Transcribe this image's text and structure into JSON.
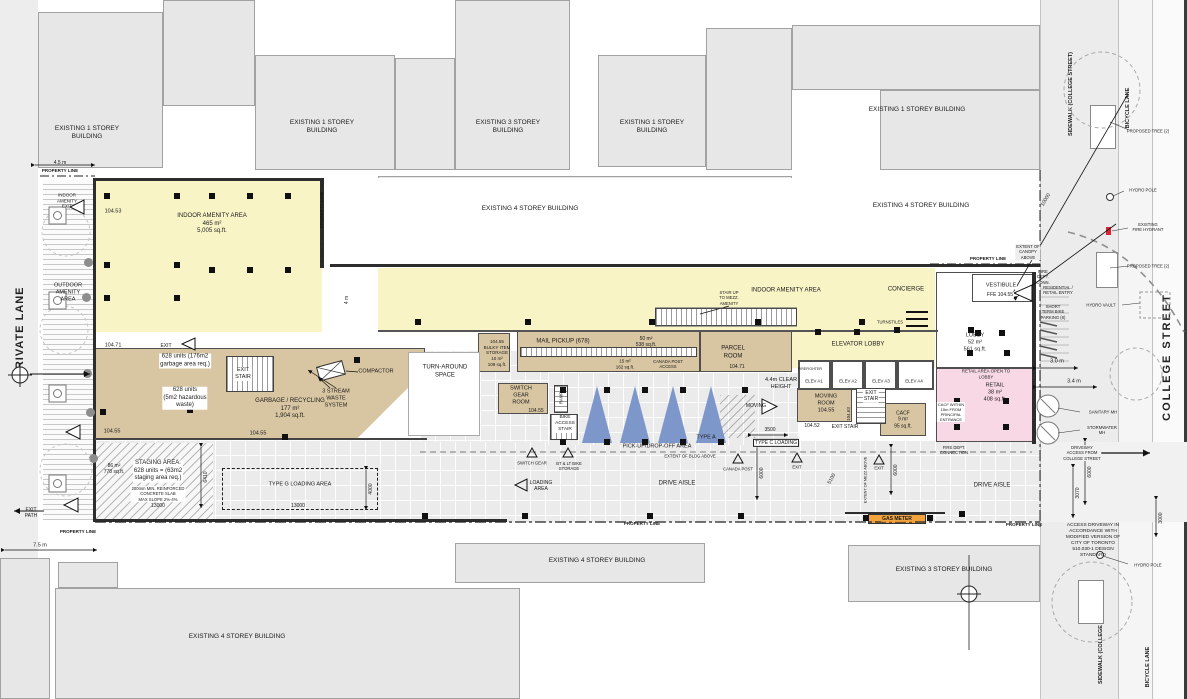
{
  "streets": {
    "private_lane": "PRIVATE LANE",
    "college_street": "COLLEGE STREET",
    "sidewalk_college_top": "SIDEWALK (COLLEGE STREET)",
    "bicycle_lane_top": "BICYCLE LANE",
    "sidewalk_college_bottom": "SIDEWALK (COLLEGE STREET)",
    "bicycle_lane_bottom": "BICYCLE LANE"
  },
  "colors": {
    "amenity_yellow": "#f8f4c6",
    "service_tan": "#d8c5a2",
    "retail_pink": "#f8d8e4",
    "tree_blue": "#7e97cb",
    "gas_meter_orange": "#f2a33c",
    "existing_building_gray": "#e7e7e7"
  },
  "annotations": [
    {
      "n": "bldg-label",
      "t": "EXISTING 1 STOREY\nBUILDING",
      "x": 87,
      "y": 133,
      "s": 6.5
    },
    {
      "n": "bldg-label",
      "t": "EXISTING 1 STOREY\nBUILDING",
      "x": 322,
      "y": 127,
      "s": 6.5
    },
    {
      "n": "bldg-label",
      "t": "EXISTING 3 STOREY\nBUILDING",
      "x": 508,
      "y": 127,
      "s": 6.5
    },
    {
      "n": "bldg-label",
      "t": "EXISTING 1 STOREY\nBUILDING",
      "x": 652,
      "y": 127,
      "s": 6.5
    },
    {
      "n": "bldg-label",
      "t": "EXISTING 1 STOREY BUILDING",
      "x": 917,
      "y": 110,
      "s": 6.5
    },
    {
      "n": "bldg-label",
      "t": "EXISTING 4 STOREY BUILDING",
      "x": 530,
      "y": 209,
      "s": 6.5
    },
    {
      "n": "bldg-label",
      "t": "EXISTING 4 STOREY BUILDING",
      "x": 921,
      "y": 206,
      "s": 6.5
    },
    {
      "n": "bldg-label",
      "t": "EXISTING 4 STOREY BUILDING",
      "x": 597,
      "y": 561,
      "s": 6.5
    },
    {
      "n": "bldg-label",
      "t": "EXISTING 3 STOREY BUILDING",
      "x": 944,
      "y": 570,
      "s": 6.5
    },
    {
      "n": "bldg-label",
      "t": "EXISTING 4 STOREY BUILDING",
      "x": 237,
      "y": 637,
      "s": 6.5
    },
    {
      "n": "room-label-indoor-amenity-west",
      "t": "INDOOR AMENITY AREA\n465 m²\n5,005 sq.ft.",
      "x": 212,
      "y": 224
    },
    {
      "n": "elevation-label",
      "t": "104.53",
      "x": 113,
      "y": 212,
      "s": 5.5
    },
    {
      "n": "room-label-outdoor-amenity",
      "t": "OUTDOOR\nAMENITY\nAREA",
      "x": 68,
      "y": 293,
      "s": 5.5
    },
    {
      "n": "room-label-indoor-amenity-exit",
      "t": "INDOOR\nAMENITY\nEXIT",
      "x": 67,
      "y": 201,
      "s": 4.5
    },
    {
      "n": "property-line-label",
      "t": "PROPERTY LINE",
      "x": 60,
      "y": 171,
      "s": 4.5,
      "b": 1
    },
    {
      "n": "dim-label",
      "t": "4.5 m",
      "x": 60,
      "y": 163,
      "s": 5
    },
    {
      "n": "property-line-label",
      "t": "PROPERTY LINE",
      "x": 322,
      "y": 210,
      "r": -90,
      "s": 4.5,
      "b": 1
    },
    {
      "n": "dim-label",
      "t": "4 m",
      "x": 347,
      "y": 300,
      "r": -90,
      "s": 5
    },
    {
      "n": "elevation-label",
      "t": "104.71",
      "x": 113,
      "y": 346,
      "s": 5.5
    },
    {
      "n": "exit-label",
      "t": "EXIT",
      "x": 166,
      "y": 346,
      "s": 5
    },
    {
      "n": "room-label-exit-stair",
      "t": "EXIT\nSTAIR",
      "x": 243,
      "y": 374,
      "s": 5.5,
      "bg": "#fff"
    },
    {
      "n": "note-label",
      "t": "628 units (176m2\ngarbage area req.)",
      "x": 185,
      "y": 361,
      "bg": "#fff"
    },
    {
      "n": "note-label",
      "t": "628 units\n(5m2 hazardous\nwaste)",
      "x": 185,
      "y": 398,
      "bg": "#fff"
    },
    {
      "n": "room-label-garbage",
      "t": "GARBAGE / RECYCLING\n177 m²\n1,904 sq.ft.",
      "x": 290,
      "y": 409
    },
    {
      "n": "equip-label-compactor",
      "t": "COMPACTOR",
      "x": 376,
      "y": 372,
      "s": 5.5
    },
    {
      "n": "equip-label-waste",
      "t": "3 STREAM\nWASTE\nSYSTEM",
      "x": 336,
      "y": 399,
      "s": 5.5
    },
    {
      "n": "elevation-label",
      "t": "104.55",
      "x": 112,
      "y": 432,
      "s": 5.5
    },
    {
      "n": "elevation-label",
      "t": "104.55",
      "x": 258,
      "y": 434,
      "s": 5.5
    },
    {
      "n": "room-label-turnaround",
      "t": "TURN-AROUND\nSPACE",
      "x": 445,
      "y": 372
    },
    {
      "n": "note-label-staging",
      "t": "STAGING AREA:\n628 units = (63m2\nstaging area req.)",
      "x": 158,
      "y": 471,
      "bg": "#fff"
    },
    {
      "n": "note-label",
      "t": "86 m²\n778 sq.ft.",
      "x": 114,
      "y": 469,
      "s": 5
    },
    {
      "n": "note-label",
      "t": "200mm MIN. REINFORCED\nCONCRETE SLAB\nMAX SLOPE 2%-4%",
      "x": 158,
      "y": 494,
      "s": 4.2,
      "bg": "#fff"
    },
    {
      "n": "dim-label",
      "t": "13000",
      "x": 158,
      "y": 506,
      "s": 5
    },
    {
      "n": "room-label-type-g-loading",
      "t": "TYPE G LOADING AREA",
      "x": 300,
      "y": 485,
      "s": 5.5
    },
    {
      "n": "dim-label",
      "t": "13000",
      "x": 298,
      "y": 506,
      "s": 5
    },
    {
      "n": "dim-label",
      "t": "6410",
      "x": 206,
      "y": 477,
      "r": -90,
      "s": 5
    },
    {
      "n": "dim-label",
      "t": "4000",
      "x": 371,
      "y": 489,
      "r": -90,
      "s": 5
    },
    {
      "n": "room-label-bulky",
      "t": "104.55\nBULKY ITEM\nSTORAGE\n10 m²\n108 sq.ft.",
      "x": 497,
      "y": 353,
      "s": 4.5
    },
    {
      "n": "room-label-mail",
      "t": "MAIL PICKUP (678)",
      "x": 563,
      "y": 342
    },
    {
      "n": "note-label",
      "t": "50 m²\n538 sq.ft.",
      "x": 646,
      "y": 342,
      "s": 5
    },
    {
      "n": "note-label",
      "t": "15 m²\n162 sq.ft.",
      "x": 625,
      "y": 364,
      "s": 4.5
    },
    {
      "n": "note-label",
      "t": "CANADA POST\nACCESS",
      "x": 668,
      "y": 364,
      "s": 4.2
    },
    {
      "n": "room-label-parcel",
      "t": "PARCEL\nROOM",
      "x": 733,
      "y": 353
    },
    {
      "n": "elevation-label",
      "t": "104.71",
      "x": 737,
      "y": 367,
      "s": 5
    },
    {
      "n": "room-label-switchgear",
      "t": "SWITCH\nGEAR\nROOM",
      "x": 521,
      "y": 396,
      "s": 5.5
    },
    {
      "n": "elevation-label",
      "t": "104.55",
      "x": 536,
      "y": 411,
      "s": 5
    },
    {
      "n": "room-label-ramp",
      "t": "RAMP",
      "x": 561,
      "y": 398,
      "r": -90,
      "s": 4.2
    },
    {
      "n": "room-label-bike-stair",
      "t": "BIKE\nACCESS\nSTAIR",
      "x": 565,
      "y": 424,
      "s": 4.8,
      "bg": "#fff"
    },
    {
      "n": "area-label-pickup",
      "t": "PICK-UP/DROP-OFF AREA",
      "x": 657,
      "y": 447,
      "s": 5.5
    },
    {
      "n": "note-label",
      "t": "TYPE A",
      "x": 706,
      "y": 438,
      "s": 5.5
    },
    {
      "n": "note-label",
      "t": "EXTENT OF BLDG ABOVE",
      "x": 690,
      "y": 456,
      "s": 4.2
    },
    {
      "n": "area-label-drive-aisle",
      "t": "DRIVE AISLE",
      "x": 677,
      "y": 484
    },
    {
      "n": "area-label-drive-aisle",
      "t": "DRIVE AISLE",
      "x": 992,
      "y": 486
    },
    {
      "n": "marker-label",
      "t": "SWITCH GEAR",
      "x": 532,
      "y": 463,
      "s": 4.2
    },
    {
      "n": "marker-label",
      "t": "BT & LT BIKE\nSTORAGE",
      "x": 569,
      "y": 466,
      "s": 4.2
    },
    {
      "n": "marker-label",
      "t": "LOADING\nAREA",
      "x": 541,
      "y": 486,
      "s": 5
    },
    {
      "n": "marker-label",
      "t": "CANADA POST",
      "x": 738,
      "y": 469,
      "s": 4.2
    },
    {
      "n": "marker-label",
      "t": "EXIT",
      "x": 797,
      "y": 467,
      "s": 4.2
    },
    {
      "n": "room-label-type-c-loading",
      "t": "TYPE C LOADING",
      "x": 776,
      "y": 443,
      "s": 5,
      "bg": "#fff",
      "bd": 1
    },
    {
      "n": "dim-label",
      "t": "3500",
      "x": 770,
      "y": 430,
      "s": 5
    },
    {
      "n": "dim-label",
      "t": "6000",
      "x": 762,
      "y": 473,
      "r": -90,
      "s": 5
    },
    {
      "n": "dim-label",
      "t": "5100",
      "x": 832,
      "y": 479,
      "r": -62,
      "s": 5
    },
    {
      "n": "dim-label",
      "t": "6000",
      "x": 896,
      "y": 470,
      "r": -90,
      "s": 5
    },
    {
      "n": "note-label",
      "t": "MOVING",
      "x": 756,
      "y": 406,
      "s": 5
    },
    {
      "n": "note-label",
      "t": "4.4m CLEAR\nHEIGHT",
      "x": 781,
      "y": 384,
      "s": 5.5
    },
    {
      "n": "room-label-moving",
      "t": "MOVING\nROOM\n104.55",
      "x": 826,
      "y": 404,
      "s": 5.5
    },
    {
      "n": "room-label-exit-stair",
      "t": "EXIT\nSTAIR",
      "x": 871,
      "y": 396,
      "s": 5,
      "bg": "#fff"
    },
    {
      "n": "elevation-label",
      "t": "104.63",
      "x": 849,
      "y": 414,
      "r": -90,
      "s": 4.5
    },
    {
      "n": "elevation-label",
      "t": "104.52",
      "x": 812,
      "y": 426,
      "s": 5
    },
    {
      "n": "room-label-exit-stair",
      "t": "EXIT STAIR",
      "x": 845,
      "y": 427,
      "s": 5
    },
    {
      "n": "room-label-cacf",
      "t": "CACF\n9 m²\n95 sq.ft.",
      "x": 903,
      "y": 420,
      "s": 5
    },
    {
      "n": "equip-label-gas-meter",
      "t": "GAS METER",
      "x": 897,
      "y": 519,
      "s": 5,
      "b": 1,
      "bg": "#f2a33c"
    },
    {
      "n": "note-label",
      "t": "FIRE DEPT.\nCONNECTION",
      "x": 954,
      "y": 450,
      "s": 4.2
    },
    {
      "n": "marker-label",
      "t": "EXIT",
      "x": 879,
      "y": 468,
      "s": 4.2
    },
    {
      "n": "note-label",
      "t": "EXTENT OF MEZZ ABOVE",
      "x": 866,
      "y": 480,
      "r": -90,
      "s": 3.8
    },
    {
      "n": "room-label-indoor-amenity-east",
      "t": "INDOOR AMENITY AREA",
      "x": 786,
      "y": 291
    },
    {
      "n": "note-label",
      "t": "STAIR UP\nTO MEZZ.\nAMENITY",
      "x": 729,
      "y": 298,
      "s": 4.2
    },
    {
      "n": "room-label-concierge",
      "t": "CONCIERGE",
      "x": 906,
      "y": 290
    },
    {
      "n": "equip-label-turnstiles",
      "t": "TURNSTILES",
      "x": 890,
      "y": 322,
      "s": 4.2
    },
    {
      "n": "room-label-elevator-lobby",
      "t": "ELEVATOR LOBBY",
      "x": 858,
      "y": 345
    },
    {
      "n": "note-label",
      "t": "FIREFIGHTER",
      "x": 810,
      "y": 369,
      "s": 3.6
    },
    {
      "n": "room-label-elev-a1",
      "t": "ELEV A1",
      "x": 814,
      "y": 381,
      "s": 4.4
    },
    {
      "n": "room-label-elev-a2",
      "t": "ELEV A2",
      "x": 848,
      "y": 381,
      "s": 4.4
    },
    {
      "n": "room-label-elev-a3",
      "t": "ELEV A3",
      "x": 881,
      "y": 381,
      "s": 4.4
    },
    {
      "n": "room-label-elev-a4",
      "t": "ELEV A4",
      "x": 914,
      "y": 381,
      "s": 4.4
    },
    {
      "n": "room-label-vestibule",
      "t": "VESTIBULE",
      "x": 1001,
      "y": 286,
      "s": 5.5,
      "bg": "#fff"
    },
    {
      "n": "elevation-label",
      "t": "FFE 104.55",
      "x": 1000,
      "y": 295,
      "s": 5,
      "bg": "#fff"
    },
    {
      "n": "room-label-lobby",
      "t": "LOBBY\n52 m²\n561 sq.ft.",
      "x": 975,
      "y": 343,
      "s": 5.5
    },
    {
      "n": "note-label",
      "t": "RETAIL AREA OPEN TO\nLOBBY",
      "x": 986,
      "y": 374,
      "s": 4.4
    },
    {
      "n": "room-label-retail",
      "t": "RETAIL\n38 m²\n408 sq.ft.",
      "x": 995,
      "y": 393,
      "s": 5.5
    },
    {
      "n": "note-label",
      "t": "CACF WITHIN\n15m FROM\nPRINCIPAL\nENTRANCE",
      "x": 951,
      "y": 412,
      "s": 4,
      "bg": "#fff"
    },
    {
      "n": "property-line-label",
      "t": "PROPERTY LINE",
      "x": 988,
      "y": 259,
      "s": 4.5,
      "b": 1
    },
    {
      "n": "note-label",
      "t": "EXTENT OF\nCANOPY\nABOVE",
      "x": 1028,
      "y": 252,
      "s": 4.2,
      "bg": "#eee"
    },
    {
      "n": "note-label",
      "t": "FIRE\nDEPT.\nCONN.",
      "x": 1043,
      "y": 277,
      "s": 4.2
    },
    {
      "n": "note-label",
      "t": "RESIDENTIAL /\nRETAIL ENTRY",
      "x": 1058,
      "y": 290,
      "s": 4.2
    },
    {
      "n": "note-label",
      "t": "SHORT\nTERM BIKE\nPARKING (8)",
      "x": 1053,
      "y": 312,
      "s": 4.2
    },
    {
      "n": "note-label",
      "t": "HYDRO VAULT",
      "x": 1101,
      "y": 305,
      "s": 4.2
    },
    {
      "n": "dim-label",
      "t": "10000",
      "x": 1046,
      "y": 200,
      "r": -60,
      "s": 5
    },
    {
      "n": "note-label",
      "t": "PROPOSED TREE (2)",
      "x": 1148,
      "y": 131,
      "s": 4.2
    },
    {
      "n": "note-label",
      "t": "HYDRO POLE",
      "x": 1143,
      "y": 190,
      "s": 4.2
    },
    {
      "n": "note-label",
      "t": "EXISTING\nFIRE HYDRANT",
      "x": 1148,
      "y": 227,
      "s": 4.2
    },
    {
      "n": "note-label",
      "t": "PROPOSED TREE (2)",
      "x": 1148,
      "y": 266,
      "s": 4.2
    },
    {
      "n": "dim-label",
      "t": "3.0 m",
      "x": 1057,
      "y": 362,
      "s": 5.5
    },
    {
      "n": "dim-label",
      "t": "3.4 m",
      "x": 1074,
      "y": 382,
      "s": 5.5
    },
    {
      "n": "note-label",
      "t": "SANITARY MH",
      "x": 1103,
      "y": 412,
      "s": 4.2
    },
    {
      "n": "note-label",
      "t": "STORMWATER\nMH",
      "x": 1102,
      "y": 430,
      "s": 4.2
    },
    {
      "n": "note-label",
      "t": "DRIVEWAY\nACCESS FROM\nCOLLEGE STREET",
      "x": 1082,
      "y": 453,
      "s": 4.2,
      "bg": "#f1f1f1"
    },
    {
      "n": "dim-label",
      "t": "6000",
      "x": 1090,
      "y": 472,
      "r": -90,
      "s": 5
    },
    {
      "n": "dim-label",
      "t": "3070",
      "x": 1078,
      "y": 493,
      "r": -90,
      "s": 5
    },
    {
      "n": "dim-label",
      "t": "3000",
      "x": 1161,
      "y": 518,
      "r": -90,
      "s": 5
    },
    {
      "n": "note-label-access-driveway",
      "t": "ACCESS DRIVEWAY IN\nACCORDANCE WITH\nMODIFIED VERSION OF\nCITY OF TORONTO\n510.030-1 DESIGN\nSTANDARD",
      "x": 1093,
      "y": 541,
      "s": 4.8
    },
    {
      "n": "note-label",
      "t": "HYDRO POLE",
      "x": 1148,
      "y": 565,
      "s": 4.2
    },
    {
      "n": "property-line-label",
      "t": "PROPERTY LINE",
      "x": 78,
      "y": 532,
      "s": 4.5,
      "b": 1
    },
    {
      "n": "dim-label",
      "t": "7.5 m",
      "x": 40,
      "y": 546,
      "s": 5.5
    },
    {
      "n": "note-label",
      "t": "EXIT\nPATH",
      "x": 31,
      "y": 513,
      "s": 5
    },
    {
      "n": "property-line-label",
      "t": "PROPERTY LINE",
      "x": 642,
      "y": 524,
      "s": 4.5,
      "b": 1
    },
    {
      "n": "property-line-label",
      "t": "PROPERTY LINE",
      "x": 1024,
      "y": 525,
      "s": 4.5,
      "b": 1
    }
  ]
}
